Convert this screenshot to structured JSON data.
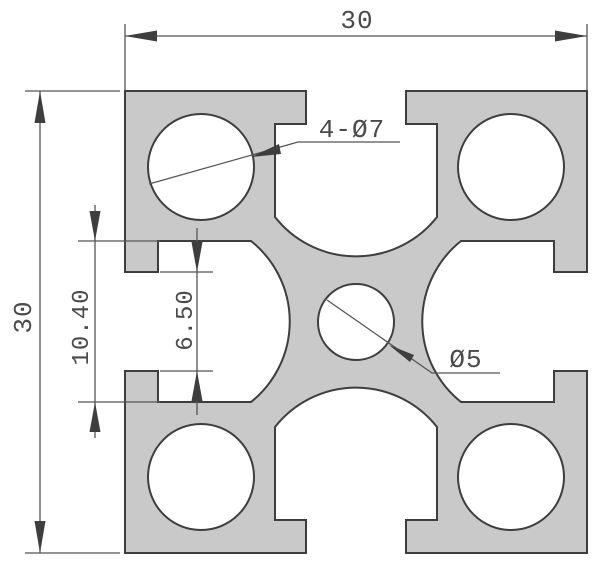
{
  "diagram": {
    "type": "engineering-cross-section",
    "subject": "extrusion-profile",
    "dims": {
      "overall_width": "30",
      "overall_height": "30",
      "slot_cavity_width": "10.40",
      "slot_opening_width": "6.50"
    },
    "labels": {
      "corner_holes": "4-Ø7",
      "center_hole": "Ø5"
    },
    "colors": {
      "material_fill": "#c9c9c9",
      "outline": "#3e3e3e",
      "dimension_lines": "#555555",
      "text": "#4a4a4a",
      "background": "#ffffff"
    }
  }
}
